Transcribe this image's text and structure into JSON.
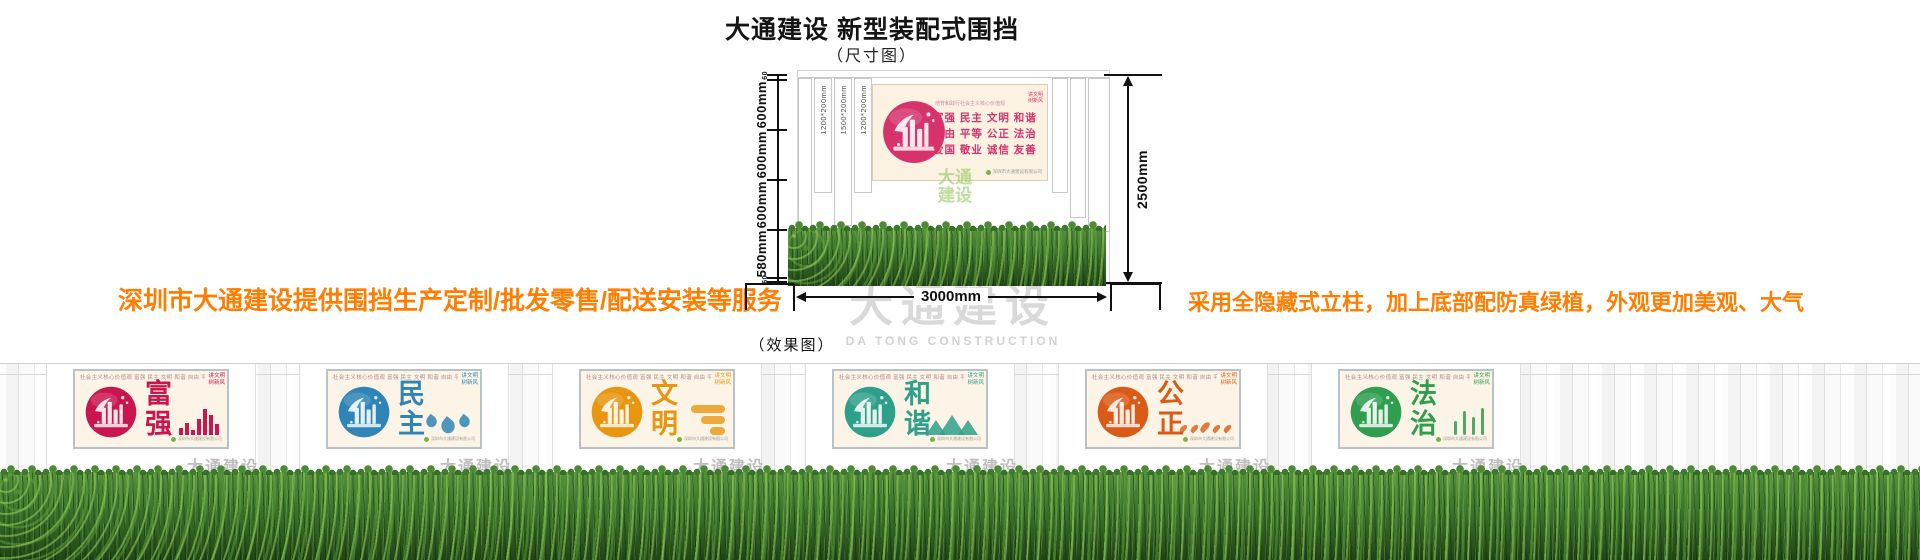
{
  "header": {
    "title": "大通建设 新型装配式围挡",
    "subtitle": "（尺寸图）"
  },
  "notes": {
    "left": "深圳市大通建设提供围挡生产定制/批发零售/配送安装等服务",
    "right": "采用全隐藏式立柱，加上底部配防真绿植，外观更加美观、大气",
    "color": "#ff7d00"
  },
  "size_diagram": {
    "height_segments": [
      "60",
      "600mm",
      "600mm",
      "600mm",
      "580mm",
      "60"
    ],
    "total_height": "2500mm",
    "total_width": "3000mm",
    "column_labels": [
      "1200*200mm",
      "1500*200mm",
      "1200*200mm"
    ],
    "panel": {
      "header": "培育和践行社会主义核心价值观",
      "rows": [
        "富强  民主  文明  和谐",
        "自由  平等  公正  法治",
        "爱国  敬业  诚信  友善"
      ],
      "corner_line1": "讲文明",
      "corner_line2": "树新风",
      "footnote": "深圳市大通建设有限公司",
      "accent": "#d6336c"
    },
    "logo_watermark_line1": "大通",
    "logo_watermark_line2": "建设"
  },
  "watermark": {
    "cn": "大通建设",
    "en": "DA TONG CONSTRUCTION"
  },
  "effect_label": "（效果图）",
  "effect_panels": {
    "top_line": "社会主义核心价值观  富强 民主 文明 和谐 自由 平等 公正 法治 爱国 敬业 诚信 友善",
    "corner_line1": "讲文明",
    "corner_line2": "树新风",
    "footnote": "深圳市大通建设有限公司",
    "watermark": "大通建设",
    "items": [
      {
        "word": "富强",
        "color": "#c9164e",
        "motif": "bars"
      },
      {
        "word": "民主",
        "color": "#2f85b8",
        "motif": "birds"
      },
      {
        "word": "文明",
        "color": "#e8960f",
        "motif": "clouds"
      },
      {
        "word": "和谐",
        "color": "#2ea08a",
        "motif": "mountains"
      },
      {
        "word": "公正",
        "color": "#d95b17",
        "motif": "blossoms"
      },
      {
        "word": "法治",
        "color": "#2f9e4f",
        "motif": "reeds"
      }
    ]
  }
}
